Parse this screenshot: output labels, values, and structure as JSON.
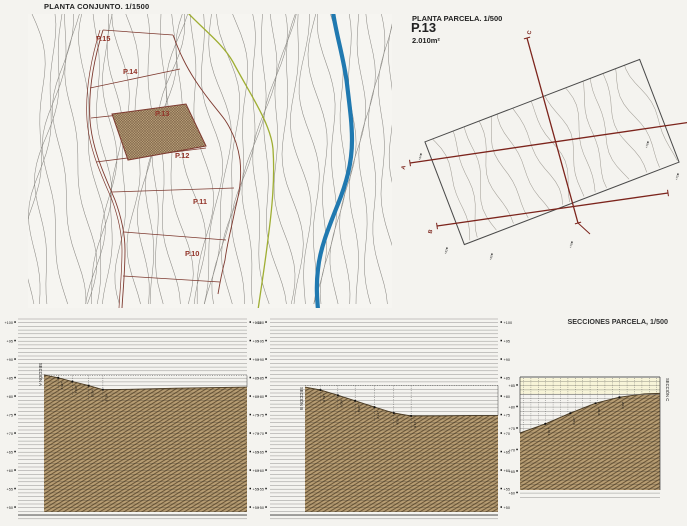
{
  "page": {
    "background": "#f4f3ef"
  },
  "colors": {
    "maroon": "#7e3a30",
    "label_red": "#93352a",
    "contour": "#8d8b86",
    "contour_light": "#a39f97",
    "river_blue": "#2079b0",
    "path_green": "#9fae33",
    "terrain_tan": "#b79d73",
    "terrain_hatch": "#5d492c",
    "cream": "#f7f4d8",
    "ruled_line": "#30302e",
    "frame": "#3a3a3a",
    "section_red": "#7c241c"
  },
  "planta_conjunto": {
    "title": "PLANTA CONJUNTO. 1/1500",
    "parcels": [
      "P.15",
      "P.14",
      "P.13",
      "P.12",
      "P.11",
      "P.10"
    ],
    "highlighted_parcel": "P.13"
  },
  "planta_parcela": {
    "title": "PLANTA PARCELA. 1/500",
    "parcel_id": "P.13",
    "area": "2.010m²",
    "section_marks": [
      "A",
      "B",
      "C"
    ],
    "edge_marks": [
      "+84",
      "+82",
      "+80",
      "+78",
      "+76",
      "+75"
    ]
  },
  "secciones": {
    "title": "SECCIONES PARCELA, 1/500",
    "unit": "m",
    "sections": [
      {
        "name": "SECCIÓN A",
        "elevation_labels": [
          "+100",
          "+95",
          "+90",
          "+85",
          "+80",
          "+75",
          "+70",
          "+65",
          "+60",
          "+55",
          "+50"
        ],
        "profile": [
          [
            0,
            85.9
          ],
          [
            0.07,
            85.1
          ],
          [
            0.14,
            84.1
          ],
          [
            0.22,
            83.0
          ],
          [
            0.29,
            81.9
          ],
          [
            0.42,
            82.0
          ],
          [
            0.65,
            82.3
          ],
          [
            1,
            82.6
          ]
        ],
        "spot_labels": [
          "+85,1",
          "+84,1",
          "+83,0",
          "+81,9"
        ]
      },
      {
        "name": "SECCIÓN B",
        "elevation_labels": [
          "+100",
          "+95",
          "+90",
          "+85",
          "+80",
          "+75",
          "+70",
          "+65",
          "+60",
          "+55",
          "+50"
        ],
        "profile": [
          [
            0,
            82.6
          ],
          [
            0.08,
            81.8
          ],
          [
            0.17,
            80.4
          ],
          [
            0.26,
            78.9
          ],
          [
            0.36,
            77.2
          ],
          [
            0.46,
            75.6
          ],
          [
            0.55,
            74.8
          ],
          [
            0.7,
            74.8
          ],
          [
            0.85,
            74.9
          ],
          [
            1,
            74.9
          ]
        ],
        "spot_labels": [
          "+81,8",
          "+80,4",
          "+78,9",
          "+77,2",
          "+75,6",
          "+74,8"
        ]
      },
      {
        "name": "SECCIÓN C",
        "elevation_labels": [
          "+85",
          "+80",
          "+75",
          "+70",
          "+65",
          "+60"
        ],
        "profile": [
          [
            0,
            74.0
          ],
          [
            0.18,
            76.1
          ],
          [
            0.36,
            78.6
          ],
          [
            0.54,
            80.9
          ],
          [
            0.71,
            82.3
          ],
          [
            0.89,
            83.1
          ],
          [
            1,
            83.2
          ]
        ],
        "spot_labels": [
          "+76,1",
          "+78,6",
          "+80,9",
          "+82,3"
        ]
      }
    ]
  }
}
